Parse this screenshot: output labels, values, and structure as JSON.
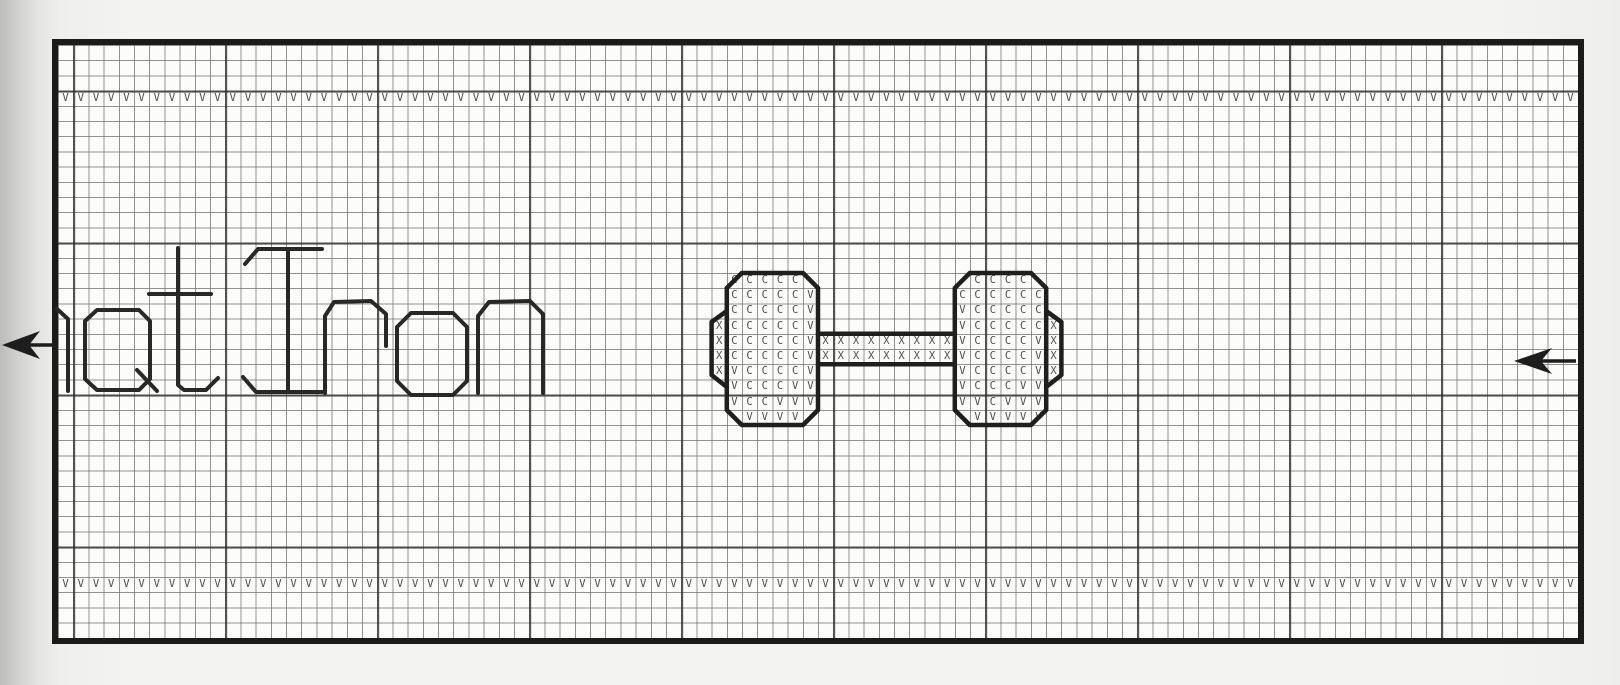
{
  "page": {
    "kind": "scanned stitch pattern chart on graph paper",
    "visible_text": "at Iron"
  },
  "grid": {
    "cols": 100,
    "rows": 39,
    "cell_px": 15.2,
    "heavy_line_every": 10,
    "paper_color": "#fcfcfa",
    "fine_line_color": "#6e6e6e",
    "heavy_line_color": "#2d2d2d",
    "border_color": "#1b1b1b"
  },
  "symbols": {
    "v_stitch": "V",
    "c_stitch": "C",
    "x_stitch": "X",
    "ink_color": "#4f4f4f"
  },
  "border_rows": [
    {
      "name": "top-selvage-row",
      "row": 3,
      "start_col": 0,
      "count": 100,
      "symbol": "V"
    },
    {
      "name": "bottom-selvage-row",
      "row": 35,
      "start_col": 0,
      "count": 100,
      "symbol": "V"
    }
  ],
  "blocks": [
    {
      "name": "left-weight-plate",
      "col": 43,
      "row": 15,
      "rows": [
        ".CCCCC.",
        ".CCCCCV",
        ".CCCCCV",
        "XCCCCCV",
        "XCCCCCV",
        "XCCCCCV",
        "XVCCCCV",
        ".VCCCVV",
        ".VCCVVV",
        "..VVVV."
      ]
    },
    {
      "name": "dumbbell-bar",
      "col": 50,
      "row": 19,
      "rows": [
        "XXXXXXXXX",
        "XXXXXXXXX"
      ]
    },
    {
      "name": "right-weight-plate",
      "col": 59,
      "row": 15,
      "rows": [
        ".CCCC..",
        "CCCCCC.",
        "VCCCCC.",
        "VCCCCCX",
        "VCCCCVX",
        "VCCCCVX",
        "VCCCCVX",
        "VCCCVV.",
        "VVCVVV.",
        ".VVVVV."
      ]
    }
  ],
  "lettering": {
    "text": "at Iron",
    "style": "backstitch outline letters, leftmost letter cut off at chart edge"
  },
  "markers": {
    "left_arrow": "center row marker, left margin, pointing left",
    "right_arrow": "center row marker, inside right edge, pointing left"
  }
}
